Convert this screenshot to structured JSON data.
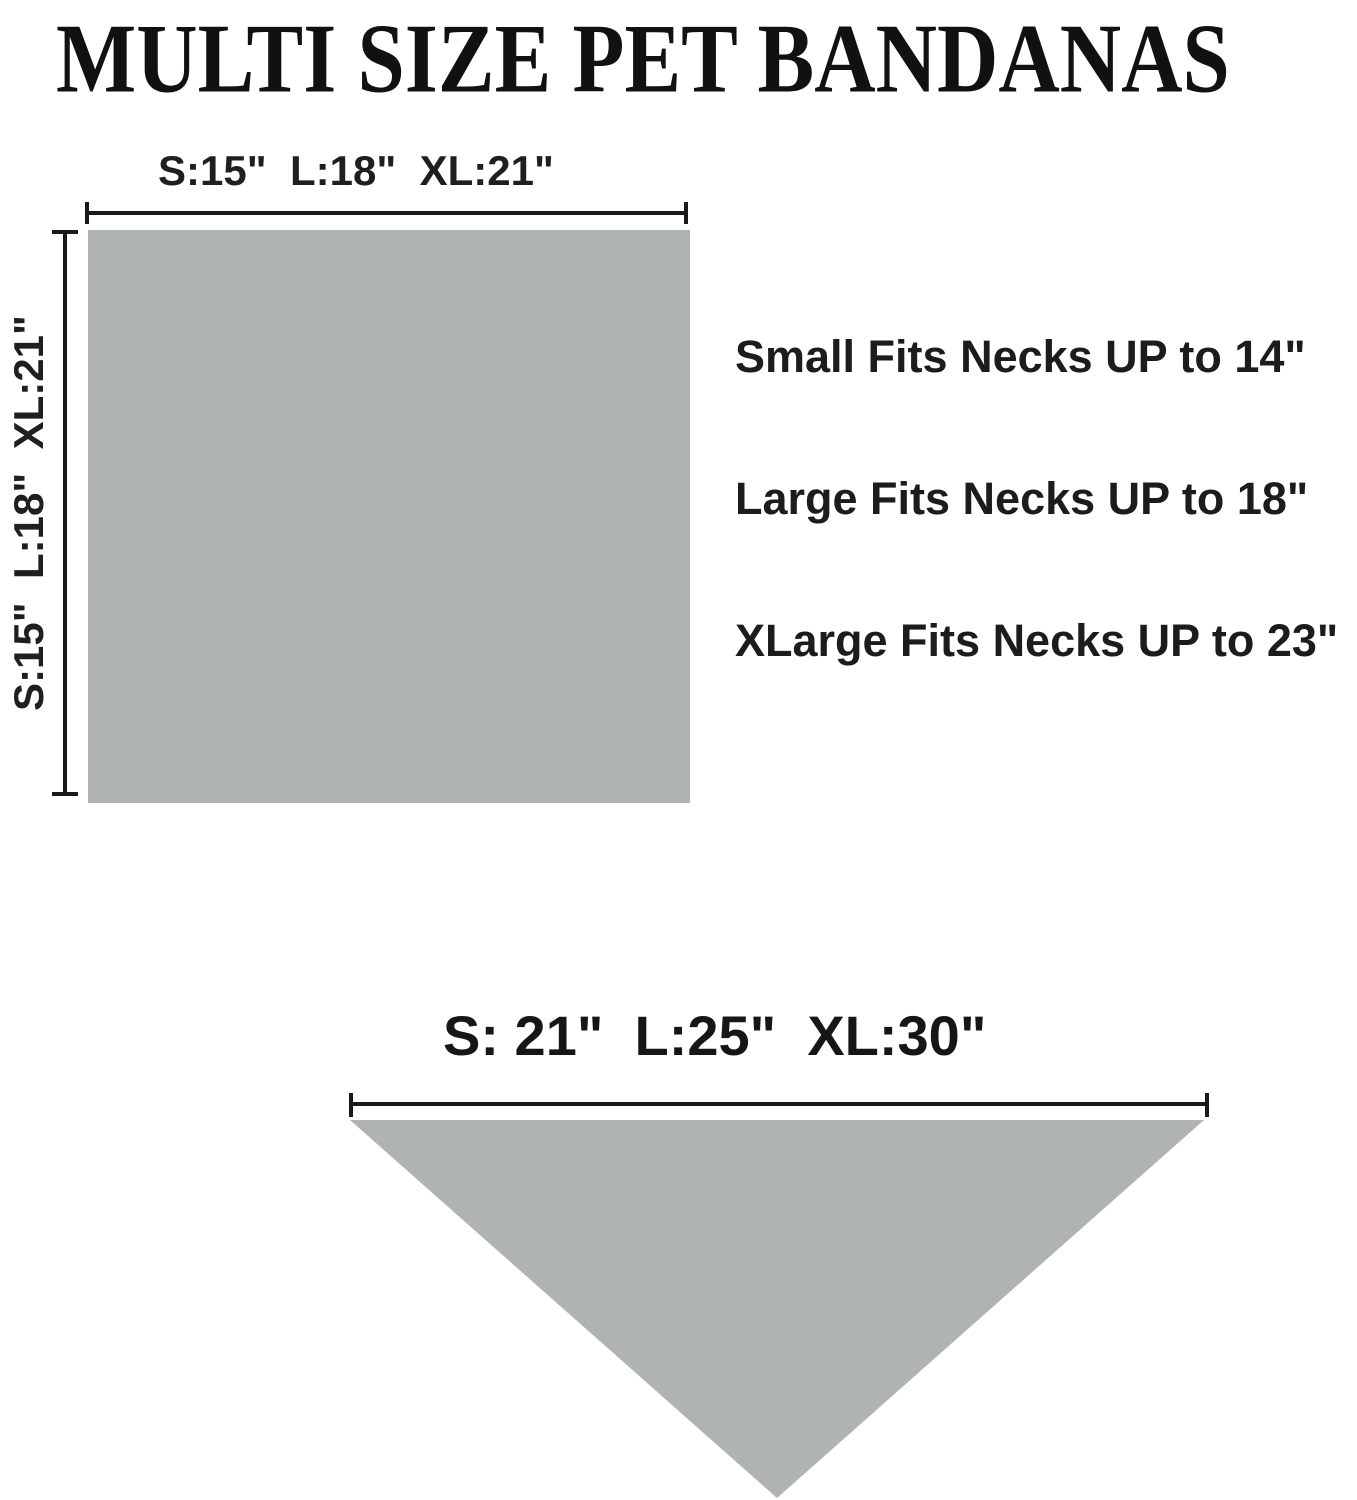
{
  "page": {
    "title": "MULTI SIZE PET BANDANAS"
  },
  "colors": {
    "background": "#ffffff",
    "text": "#1a1a1a",
    "shape_gray": "#b0b3b4",
    "line_black": "#1a1a1a"
  },
  "square_diagram": {
    "shape": "square",
    "width_label": "S:15\"  L:18\"  XL:21\"",
    "height_label": "S:15\"  L:18\"  XL:21\"",
    "widths_inches": {
      "S": 15,
      "L": 18,
      "XL": 21
    },
    "heights_inches": {
      "S": 15,
      "L": 18,
      "XL": 21
    }
  },
  "fit_notes": [
    "Small Fits Necks UP to 14\"",
    "Large Fits Necks UP to 18\"",
    "XLarge Fits Necks UP to 23\""
  ],
  "neck_fit_inches": {
    "Small": 14,
    "Large": 18,
    "XLarge": 23
  },
  "triangle_diagram": {
    "shape": "triangle",
    "width_label": "S: 21\"  L:25\"  XL:30\"",
    "widths_inches": {
      "S": 21,
      "L": 25,
      "XL": 30
    }
  }
}
